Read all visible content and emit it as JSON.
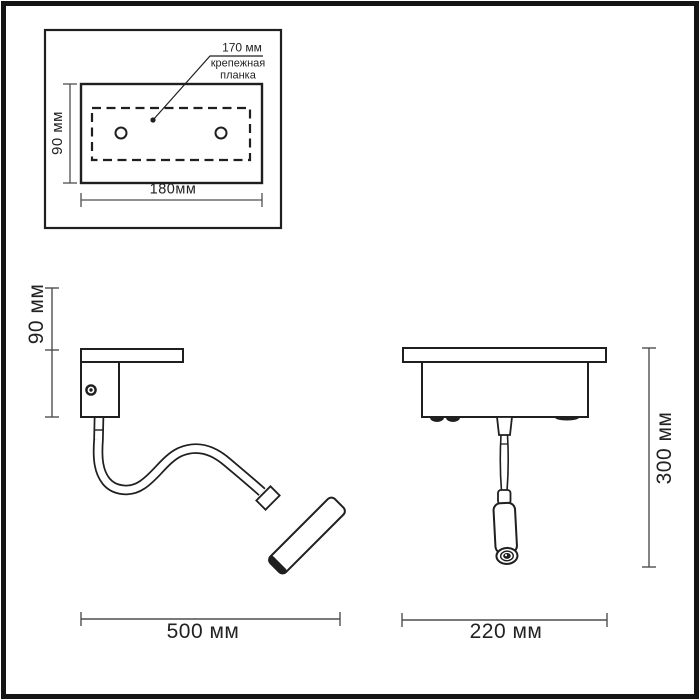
{
  "colors": {
    "background": "#ffffff",
    "line": "#1f1f1f",
    "dim_line": "#4f4f4f",
    "text": "#222222"
  },
  "top_view": {
    "spacing_label": "170 мм",
    "part_label": "крепежная\nпланка",
    "height_label": "90 мм",
    "width_label": "180мм"
  },
  "side_view": {
    "mount_height_label": "90 мм",
    "length_label": "500 мм"
  },
  "front_view": {
    "height_label": "300 мм",
    "width_label": "220 мм"
  }
}
